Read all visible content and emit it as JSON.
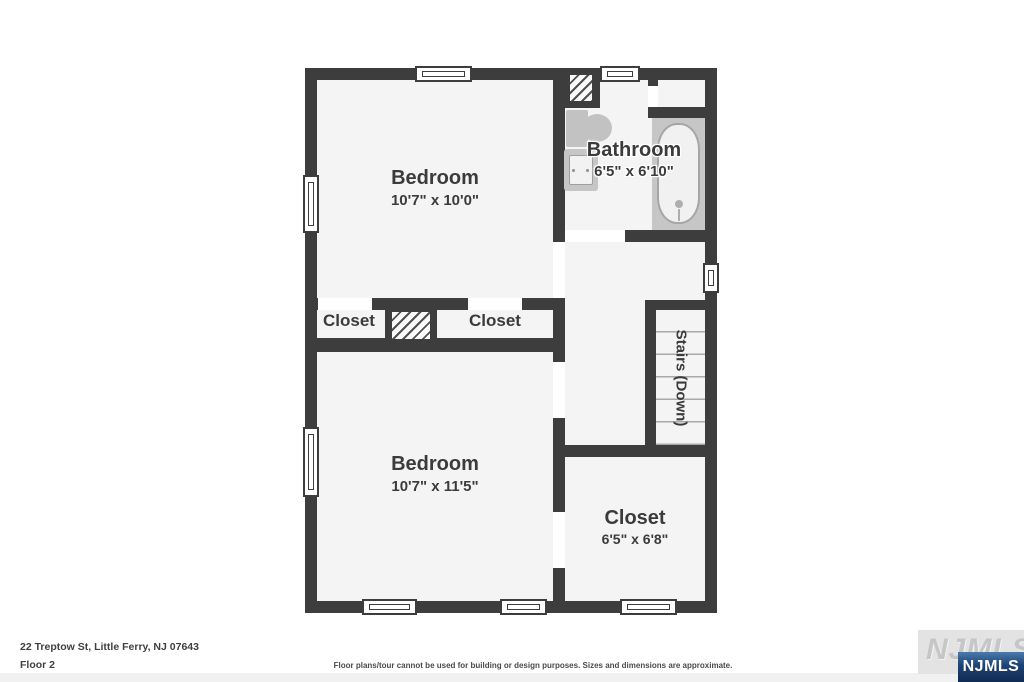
{
  "floorplan": {
    "rooms": {
      "bedroom_top": {
        "name": "Bedroom",
        "dims": "10'7\" x 10'0\""
      },
      "bathroom": {
        "name": "Bathroom",
        "dims": "6'5\" x 6'10\""
      },
      "closet_left": {
        "name": "Closet"
      },
      "closet_mid": {
        "name": "Closet"
      },
      "bedroom_bottom": {
        "name": "Bedroom",
        "dims": "10'7\" x 11'5\""
      },
      "stairs": {
        "name": "Stairs (Down)"
      },
      "closet_bottom_right": {
        "name": "Closet",
        "dims": "6'5\" x 6'8\""
      }
    },
    "colors": {
      "wall": "#3d3d3d",
      "floor": "#f4f4f4",
      "fixture_gray": "#c6c6c6",
      "label_text": "#3b3b3b"
    }
  },
  "footer": {
    "address": "22 Treptow St, Little Ferry, NJ 07643",
    "floor_label": "Floor 2",
    "disclaimer": "Floor plans/tour cannot be used for building or design purposes. Sizes and dimensions are approximate."
  },
  "watermark": {
    "logo_text": "NJMLS",
    "badge_text": "NJMLS",
    "badge_color": "#1d4273"
  }
}
